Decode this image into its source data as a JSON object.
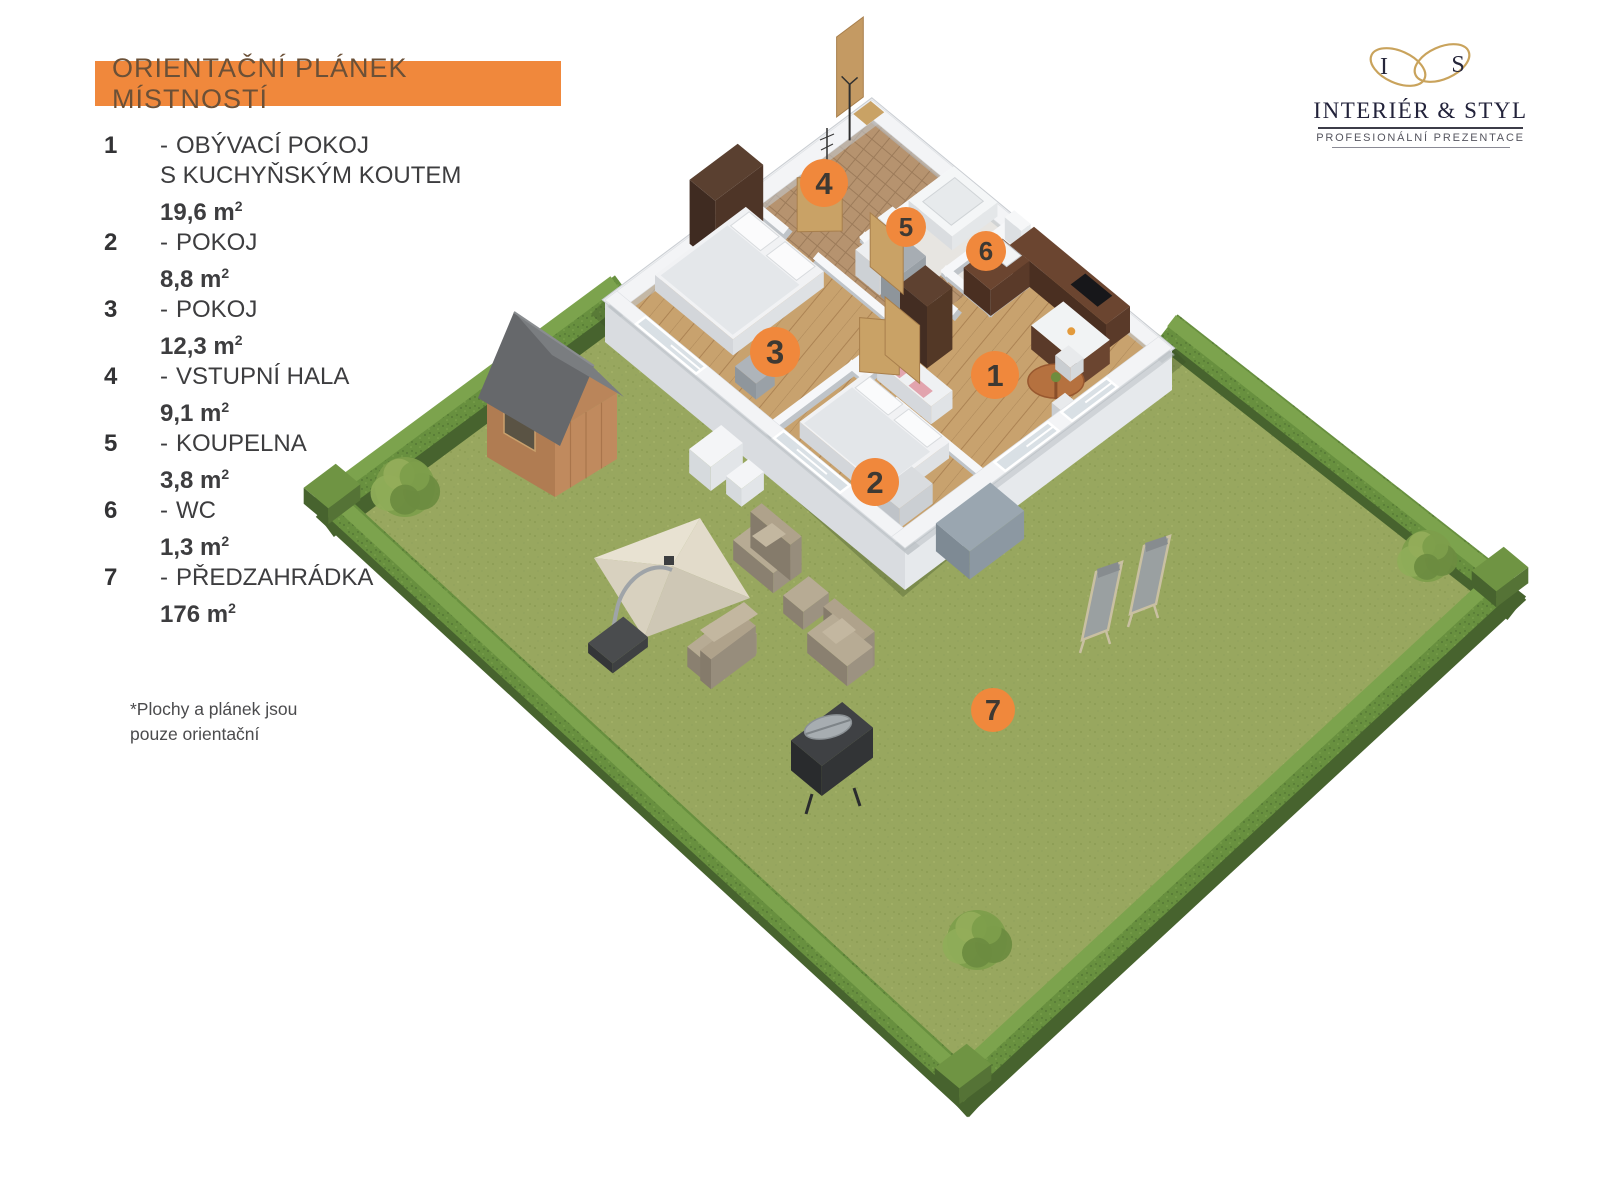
{
  "header": {
    "title": "ORIENTAČNÍ PLÁNEK MÍSTNOSTÍ"
  },
  "legend": {
    "separator": "-",
    "items": [
      {
        "num": "1",
        "name_lines": [
          "OBÝVACÍ POKOJ",
          "S KUCHYŇSKÝM KOUTEM"
        ],
        "area": "19,6 m",
        "area_sup": "2"
      },
      {
        "num": "2",
        "name_lines": [
          "POKOJ"
        ],
        "area": "8,8 m",
        "area_sup": "2"
      },
      {
        "num": "3",
        "name_lines": [
          "POKOJ"
        ],
        "area": "12,3 m",
        "area_sup": "2"
      },
      {
        "num": "4",
        "name_lines": [
          "VSTUPNÍ HALA"
        ],
        "area": "9,1 m",
        "area_sup": "2"
      },
      {
        "num": "5",
        "name_lines": [
          "KOUPELNA"
        ],
        "area": "3,8 m",
        "area_sup": "2"
      },
      {
        "num": "6",
        "name_lines": [
          "WC"
        ],
        "area": "1,3 m",
        "area_sup": "2"
      },
      {
        "num": "7",
        "name_lines": [
          "PŘEDZAHRÁDKA"
        ],
        "area": "176 m",
        "area_sup": "2"
      }
    ]
  },
  "footnote": {
    "line1": "*Plochy  a plánek jsou",
    "line2": "pouze orientační"
  },
  "logo": {
    "monogram_left": "I",
    "monogram_right": "S",
    "name": "INTERIÉR & STYL",
    "tagline": "PROFESIONÁLNÍ PREZENTACE"
  },
  "plan": {
    "markers": [
      {
        "label": "1",
        "x": 995,
        "y": 375,
        "r": 24
      },
      {
        "label": "2",
        "x": 875,
        "y": 482,
        "r": 24
      },
      {
        "label": "3",
        "x": 775,
        "y": 352,
        "r": 25
      },
      {
        "label": "4",
        "x": 824,
        "y": 183,
        "r": 24
      },
      {
        "label": "5",
        "x": 906,
        "y": 227,
        "r": 20
      },
      {
        "label": "6",
        "x": 986,
        "y": 251,
        "r": 20
      },
      {
        "label": "7",
        "x": 993,
        "y": 710,
        "r": 22
      }
    ]
  },
  "colors": {
    "accent": "#F0883C",
    "marker_number": "#3E3933",
    "header_text": "#6B5037",
    "legend_text": "#3D3D3F",
    "grass": "#98A75F",
    "hedge": "#68903F",
    "gold": "#C9A35C",
    "logo_text": "#22223A"
  }
}
